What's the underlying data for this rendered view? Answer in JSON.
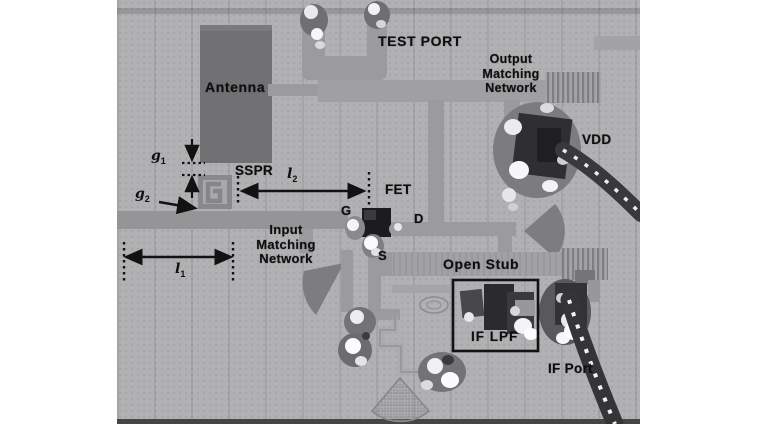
{
  "figure": {
    "type": "annotated-pcb-photograph",
    "labels": {
      "antenna": "Antenna",
      "test_port": "TEST PORT",
      "output_matching": [
        "Output",
        "Matching",
        "Network"
      ],
      "vdd": "VDD",
      "sspr": "SSPR",
      "fet": "FET",
      "gate": "G",
      "drain": "D",
      "source": "S",
      "input_matching": [
        "Input",
        "Matching",
        "Network"
      ],
      "open_stub": "Open Stub",
      "if_lpf": "IF LPF",
      "if_port": "IF Port"
    },
    "dims": {
      "g1": {
        "base": "g",
        "sub": "1"
      },
      "g2": {
        "base": "g",
        "sub": "2"
      },
      "l1": {
        "base": "l",
        "sub": "1"
      },
      "l2": {
        "base": "l",
        "sub": "2"
      }
    },
    "colors": {
      "page_bg": "#ffffff",
      "photo_bg": "#b1b1b3",
      "copper_trace": "#9b9b9d",
      "dark_patch": "#717173",
      "fet_body": "#1c1c1e",
      "annotation_ink": "#121212",
      "solder_highlight": "#f8f8f8",
      "cable": "#39393b"
    }
  }
}
